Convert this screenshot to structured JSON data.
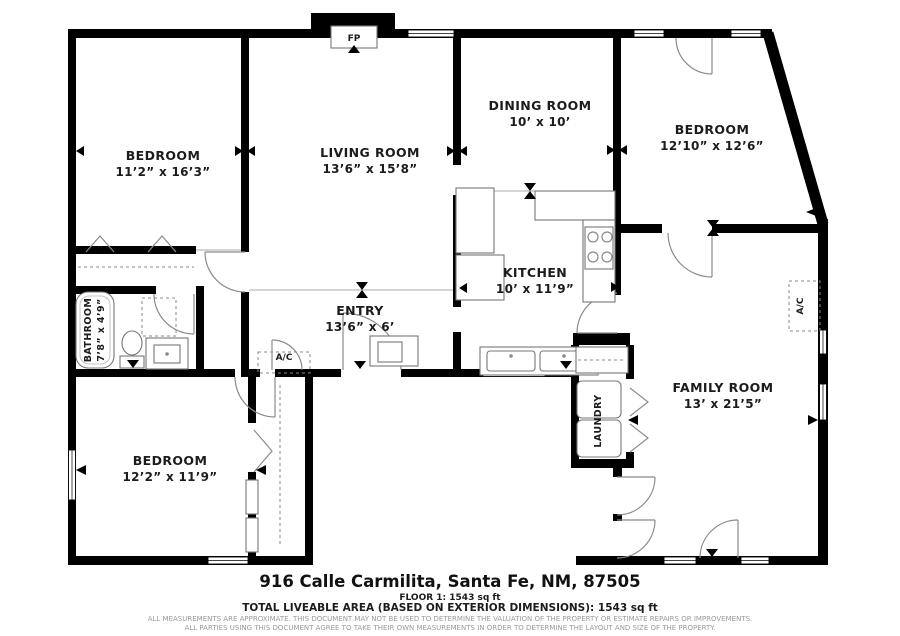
{
  "address": "916 Calle Carmilita, Santa Fe, NM, 87505",
  "floor_summary": "FLOOR 1: 1543 sq ft",
  "total_area": "TOTAL LIVEABLE AREA (BASED ON EXTERIOR DIMENSIONS): 1543 sq ft",
  "disclaimer_line1": "ALL MEASUREMENTS ARE APPROXIMATE. THIS DOCUMENT MAY NOT BE USED TO DETERMINE THE VALUATION OF THE PROPERTY OR ESTIMATE REPAIRS OR IMPROVEMENTS.",
  "disclaimer_line2": "ALL PARTIES USING THIS DOCUMENT AGREE TO TAKE THEIR OWN MEASUREMENTS IN ORDER TO DETERMINE THE LAYOUT AND SIZE OF THE PROPERTY.",
  "rooms": {
    "bedroom_top_left": {
      "name": "BEDROOM",
      "dims": "11’2” x 16’3”"
    },
    "living_room": {
      "name": "LIVING ROOM",
      "dims": "13’6” x 15’8”"
    },
    "dining_room": {
      "name": "DINING ROOM",
      "dims": "10’ x 10’"
    },
    "bedroom_top_right": {
      "name": "BEDROOM",
      "dims": "12’10” x 12’6”"
    },
    "kitchen": {
      "name": "KITCHEN",
      "dims": "10’ x 11’9”"
    },
    "entry": {
      "name": "ENTRY",
      "dims": "13’6” x 6’"
    },
    "bathroom": {
      "name": "BATHROOM",
      "dims": "7’8” x 4’9”"
    },
    "bedroom_bottom_left": {
      "name": "BEDROOM",
      "dims": "12’2” x 11’9”"
    },
    "family_room": {
      "name": "FAMILY ROOM",
      "dims": "13’ x 21’5”"
    },
    "laundry": {
      "name": "LAUNDRY"
    }
  },
  "fixtures": {
    "fireplace": "FP",
    "ac": "A/C"
  },
  "colors": {
    "walls": "#000000",
    "fixtures": "#8a8a8a",
    "text": "#1c1c1c",
    "disclaimer": "#9a9a9a",
    "background": "#ffffff"
  }
}
